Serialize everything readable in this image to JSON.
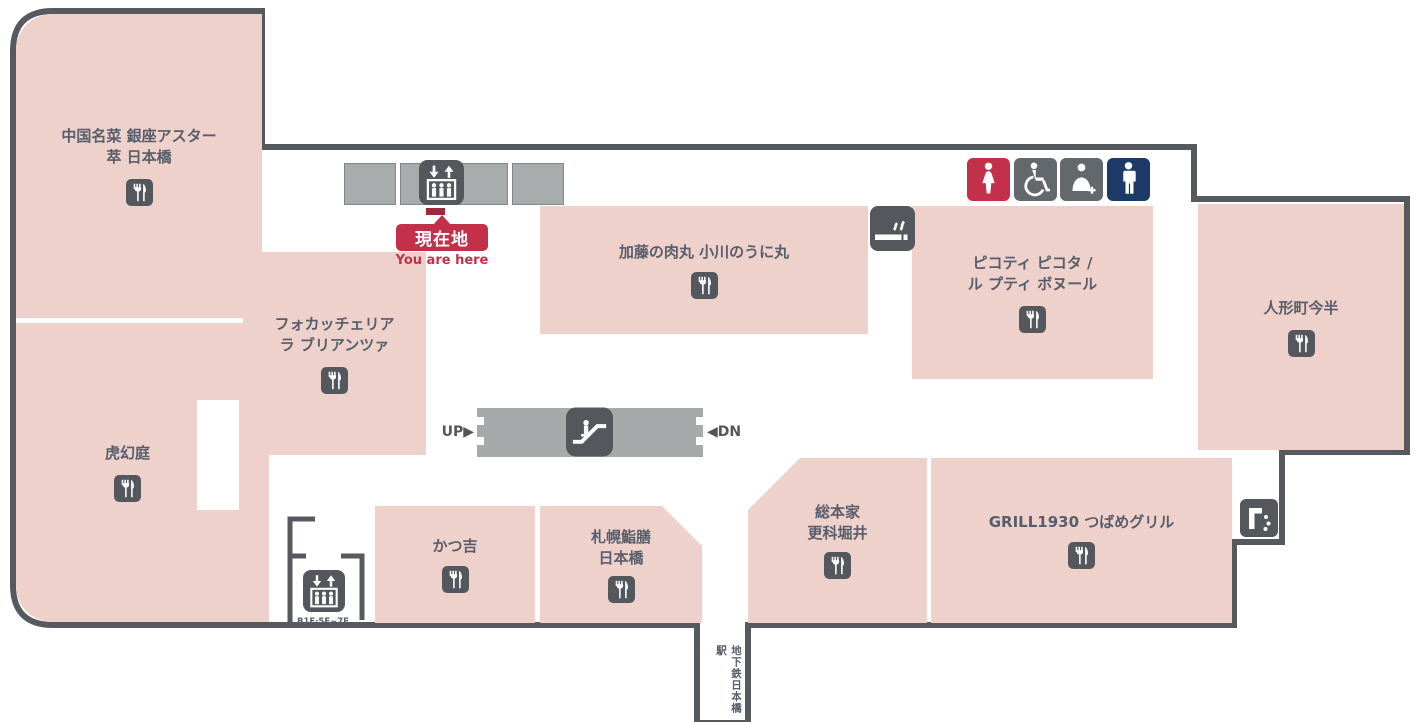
{
  "you_are_here": {
    "label": "現在地",
    "sublabel": "You are here"
  },
  "escalator": {
    "up_label": "UP",
    "up_arrow": "▶",
    "down_label": "DN",
    "down_arrow": "◀"
  },
  "elevator_small": {
    "floors_label": "B1F·5F~7F"
  },
  "corridor": {
    "station_label": "地下鉄日本橋駅"
  },
  "restaurants": [
    {
      "id": "ginza-aster",
      "lines": [
        "中国名菜 銀座アスター",
        "萃 日本橋"
      ]
    },
    {
      "id": "kogentei",
      "lines": [
        "虎幻庭"
      ]
    },
    {
      "id": "focacceria",
      "lines": [
        "フォカッチェリア",
        "ラ ブリアンツァ"
      ]
    },
    {
      "id": "nikumaru",
      "lines": [
        "加藤の肉丸 小川のうに丸"
      ]
    },
    {
      "id": "picoti",
      "lines": [
        "ピコティ ピコタ /",
        "ル プティ ボヌール"
      ]
    },
    {
      "id": "imahan",
      "lines": [
        "人形町今半"
      ]
    },
    {
      "id": "katsukichi",
      "lines": [
        "かつ吉"
      ]
    },
    {
      "id": "sapporo",
      "lines": [
        "札幌鮨膳",
        "日本橋"
      ]
    },
    {
      "id": "sarashina",
      "lines": [
        "総本家",
        "更科堀井"
      ]
    },
    {
      "id": "tsubame",
      "lines": [
        "GRILL1930 つばめグリル"
      ]
    }
  ],
  "icons": {
    "restaurant": "fork-and-knife",
    "elevator": "up-down-arrows-with-passengers",
    "escalator": "person-on-escalator",
    "smoking_area": "cigarette-with-smoke",
    "womens_toilet": "female-figure",
    "accessible_toilet": "wheelchair-user",
    "baby_care": "adult-holding-infant",
    "mens_toilet": "male-figure",
    "drinking_fountain": "faucet-with-water-drops"
  },
  "colors": {
    "shop_block": "#edd1ca",
    "wall": "#56595d",
    "icon_dark": "#54585c",
    "door_gray": "#a9acac",
    "accent_red": "#c3304a",
    "mens_navy": "#1d3a66",
    "facility_gray": "#63686c",
    "label_text": "#575d6a"
  }
}
